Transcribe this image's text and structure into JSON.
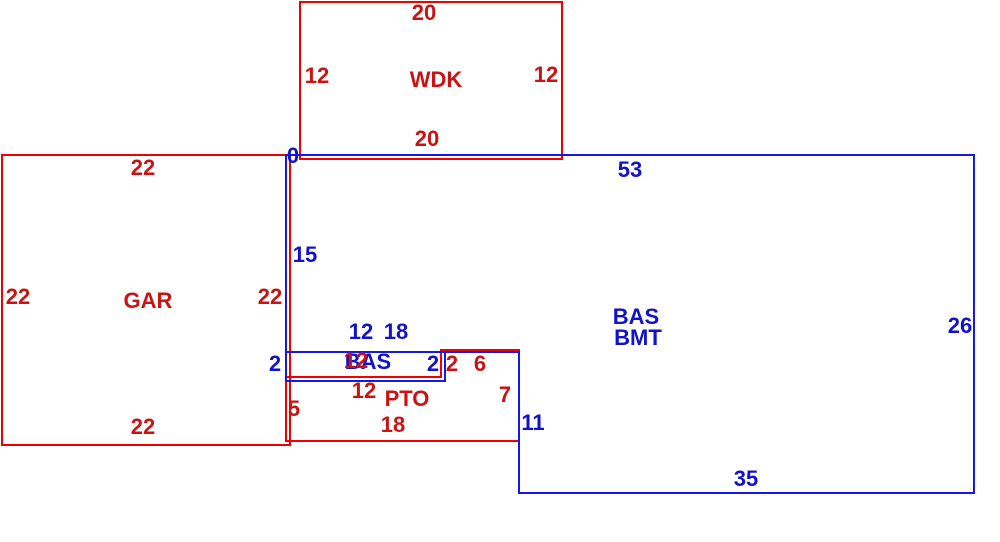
{
  "colors": {
    "red_line": "#f00000",
    "red_text": "#c81414",
    "blue_line": "#1818e6",
    "blue_text": "#1212c8"
  },
  "areas": {
    "wdk": {
      "name": "WDK",
      "dim_top": "20",
      "dim_left": "12",
      "dim_right": "12",
      "dim_bottom": "20"
    },
    "gar": {
      "name": "GAR",
      "dim_top": "22",
      "dim_left": "22",
      "dim_right": "22",
      "dim_bottom": "22"
    },
    "bas_bmt": {
      "label_line1": "BAS",
      "label_line2": "BMT",
      "origin_marker": "0",
      "dim_top": "53",
      "dim_left": "15",
      "dim_right": "26",
      "dim_bottom": "35",
      "dim_step_vertical": "11",
      "dim_step_horizontal": "18"
    },
    "bas_strip": {
      "name": "BAS",
      "dim_top": "12",
      "dim_left": "2",
      "dim_right": "2"
    },
    "pto": {
      "name": "PTO",
      "dim_top_overlay": "12",
      "dim_step_up": "2",
      "dim_step_right": "6",
      "dim_top": "12",
      "dim_right": "7",
      "dim_bottom": "18",
      "dim_left": "5"
    }
  }
}
